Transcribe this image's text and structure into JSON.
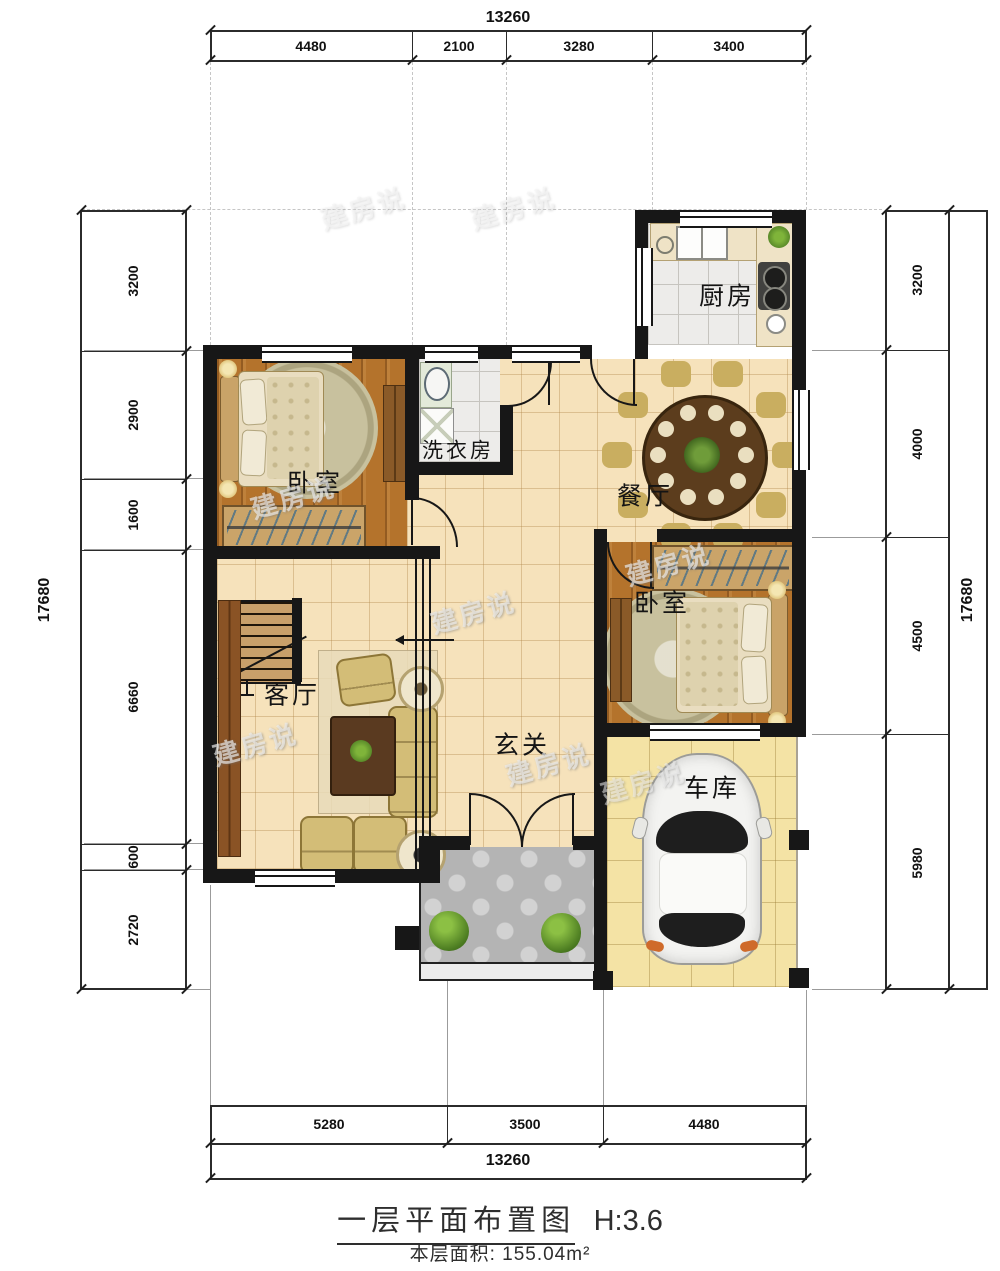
{
  "watermark": {
    "text": "建房说"
  },
  "dimensions": {
    "top": {
      "total": "13260",
      "segments": [
        "4480",
        "2100",
        "3280",
        "3400"
      ]
    },
    "bottom": {
      "total": "13260",
      "segments": [
        "5280",
        "3500",
        "4480"
      ]
    },
    "left": {
      "total": "17680",
      "segments": [
        "3200",
        "2900",
        "1600",
        "6660",
        "600",
        "2720"
      ]
    },
    "right": {
      "total": "17680",
      "segments": [
        "3200",
        "4000",
        "4500",
        "5980"
      ]
    }
  },
  "rooms": {
    "kitchen": {
      "label": "厨房"
    },
    "bedroom1": {
      "label": "卧室"
    },
    "laundry": {
      "label": "洗衣房"
    },
    "dining": {
      "label": "餐厅"
    },
    "bedroom2": {
      "label": "卧室"
    },
    "living": {
      "label": "客厅"
    },
    "hall": {
      "label": "玄关"
    },
    "garage": {
      "label": "车库"
    }
  },
  "caption": {
    "title": "一层平面布置图",
    "height_note": "H:3.6",
    "area_text": "本层面积: 155.04m²"
  }
}
